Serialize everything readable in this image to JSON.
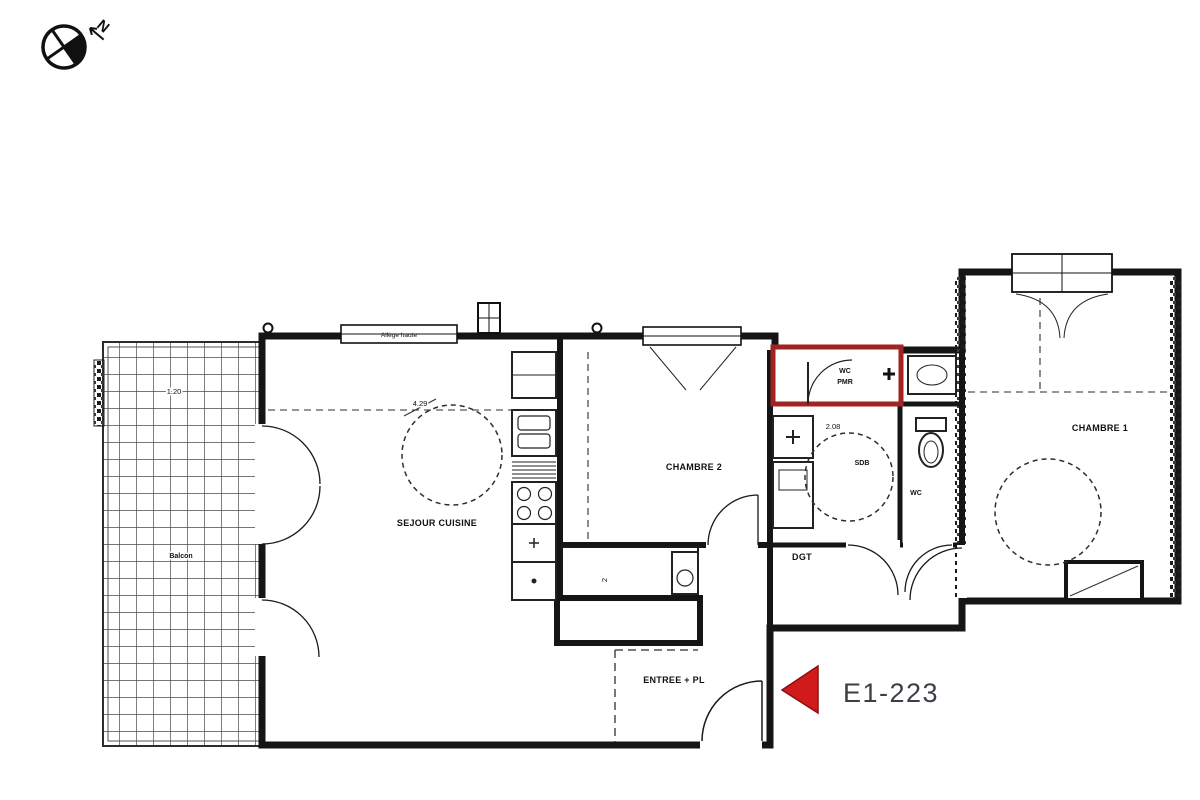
{
  "floor_plan": {
    "unit_label": "E1-223",
    "compass_label": "N",
    "rooms": {
      "sejour_cuisine": "SEJOUR CUISINE",
      "chambre_2": "CHAMBRE 2",
      "chambre_1": "CHAMBRE 1",
      "degagement": "DGT",
      "entree": "ENTREE + PL",
      "wc": "WC",
      "salle_de_bains": "SDB",
      "wc_pmr_line1": "WC",
      "wc_pmr_line2": "PMR",
      "balcon": "Balcon"
    },
    "annotations": {
      "window_note": "Allège haute"
    },
    "dimensions": {
      "sejour_width": "4.29",
      "sdb_width": "2.08",
      "balcon_depth": "1.20",
      "placard_width": "2"
    },
    "colors": {
      "wall": "#151515",
      "highlight_red": "#a32222",
      "marker_red": "#d11b1b",
      "unit_label_gray": "#3e3e46"
    }
  }
}
